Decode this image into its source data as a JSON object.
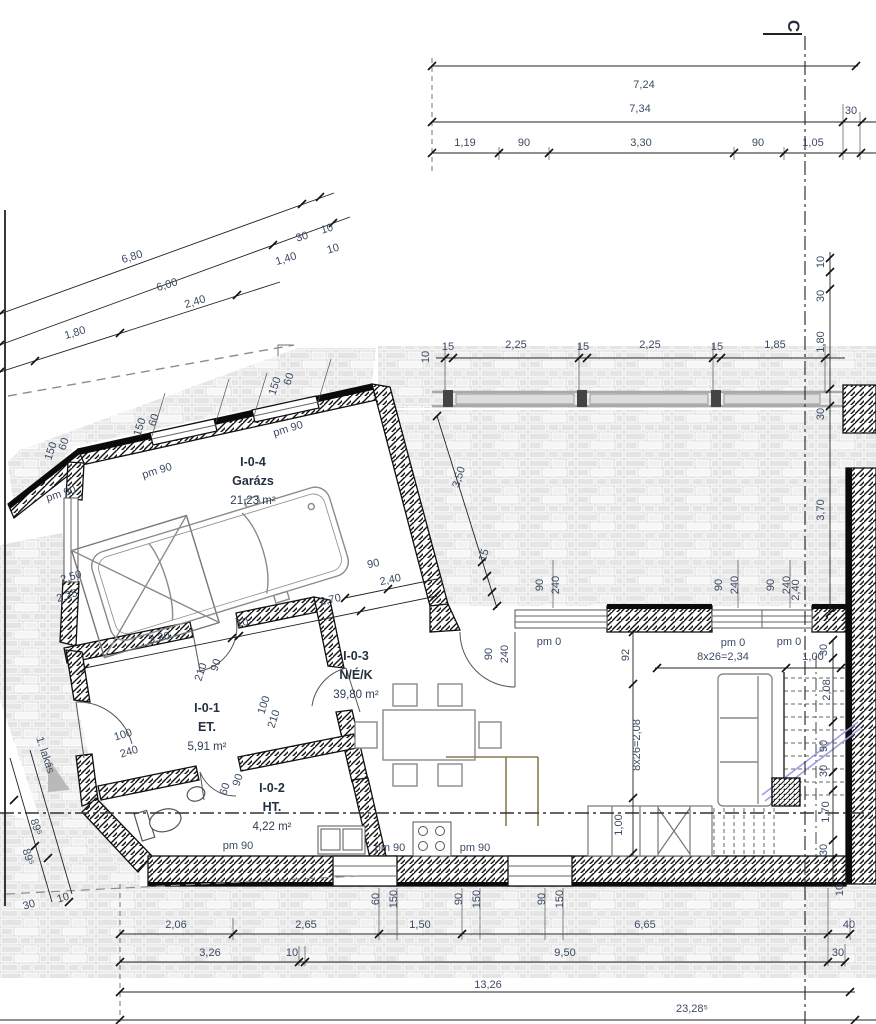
{
  "section_marker": "C",
  "apartment_pointer": "1. lakás",
  "rooms": [
    {
      "id": "I-0-4",
      "name": "Garázs",
      "area": "21,23 m²",
      "x": 253,
      "y": 466
    },
    {
      "id": "I-0-1",
      "name": "ET.",
      "area": "5,91 m²",
      "x": 207,
      "y": 712
    },
    {
      "id": "I-0-2",
      "name": "HT.",
      "area": "4,22 m²",
      "x": 272,
      "y": 792
    },
    {
      "id": "I-0-3",
      "name": "N/É/K",
      "area": "39,80 m²",
      "x": 356,
      "y": 660
    }
  ],
  "dimensions": [
    {
      "t": "7,24",
      "x": 644,
      "y": 88
    },
    {
      "t": "7,34",
      "x": 640,
      "y": 112
    },
    {
      "t": "30",
      "x": 851,
      "y": 114
    },
    {
      "t": "1,19",
      "x": 465,
      "y": 146
    },
    {
      "t": "90",
      "x": 524,
      "y": 146
    },
    {
      "t": "3,30",
      "x": 641,
      "y": 146
    },
    {
      "t": "90",
      "x": 758,
      "y": 146
    },
    {
      "t": "1,05",
      "x": 813,
      "y": 146
    },
    {
      "t": "6,80",
      "x": 133,
      "y": 260,
      "r": -17
    },
    {
      "t": "30",
      "x": 303,
      "y": 240,
      "r": -17
    },
    {
      "t": "10",
      "x": 328,
      "y": 232,
      "r": -17
    },
    {
      "t": "6,00",
      "x": 168,
      "y": 288,
      "r": -17
    },
    {
      "t": "1,40",
      "x": 287,
      "y": 262,
      "r": -17
    },
    {
      "t": "10",
      "x": 334,
      "y": 252,
      "r": -17
    },
    {
      "t": "1,80",
      "x": 76,
      "y": 336,
      "r": -17
    },
    {
      "t": "2,40",
      "x": 196,
      "y": 305,
      "r": -17
    },
    {
      "t": "15",
      "x": 448,
      "y": 350
    },
    {
      "t": "2,25",
      "x": 516,
      "y": 348
    },
    {
      "t": "15",
      "x": 583,
      "y": 350
    },
    {
      "t": "2,25",
      "x": 650,
      "y": 348
    },
    {
      "t": "15",
      "x": 717,
      "y": 350
    },
    {
      "t": "1,85",
      "x": 775,
      "y": 348
    },
    {
      "t": "10",
      "x": 429,
      "y": 357,
      "r": -90
    },
    {
      "t": "10",
      "x": 824,
      "y": 262,
      "r": -90
    },
    {
      "t": "30",
      "x": 824,
      "y": 296,
      "r": -90
    },
    {
      "t": "1,80",
      "x": 824,
      "y": 342,
      "r": -90
    },
    {
      "t": "30",
      "x": 824,
      "y": 414,
      "r": -90
    },
    {
      "t": "3,70",
      "x": 824,
      "y": 510,
      "r": -90
    },
    {
      "t": "2,40",
      "x": 799,
      "y": 590,
      "r": -90
    },
    {
      "t": "pm 90",
      "x": 62,
      "y": 497,
      "r": -17
    },
    {
      "t": "pm 90",
      "x": 158,
      "y": 474,
      "r": -17
    },
    {
      "t": "pm 90",
      "x": 289,
      "y": 432,
      "r": -17
    },
    {
      "t": "150",
      "x": 54,
      "y": 452,
      "r": -72
    },
    {
      "t": "60",
      "x": 67,
      "y": 445,
      "r": -72
    },
    {
      "t": "150",
      "x": 143,
      "y": 428,
      "r": -72
    },
    {
      "t": "60",
      "x": 157,
      "y": 421,
      "r": -72
    },
    {
      "t": "150",
      "x": 278,
      "y": 387,
      "r": -72
    },
    {
      "t": "60",
      "x": 292,
      "y": 380,
      "r": -72
    },
    {
      "t": "2,50",
      "x": 72,
      "y": 580,
      "r": -17
    },
    {
      "t": "2,25",
      "x": 68,
      "y": 599,
      "r": -17
    },
    {
      "t": "3,20",
      "x": 160,
      "y": 641,
      "r": -12
    },
    {
      "t": "10",
      "x": 243,
      "y": 626,
      "r": -12
    },
    {
      "t": "2,70",
      "x": 331,
      "y": 603,
      "r": -12
    },
    {
      "t": "90",
      "x": 374,
      "y": 567,
      "r": -12
    },
    {
      "t": "2,40",
      "x": 391,
      "y": 583,
      "r": -12
    },
    {
      "t": "100",
      "x": 124,
      "y": 738,
      "r": -17
    },
    {
      "t": "240",
      "x": 130,
      "y": 755,
      "r": -17
    },
    {
      "t": "210",
      "x": 204,
      "y": 673,
      "r": -72
    },
    {
      "t": "90",
      "x": 219,
      "y": 666,
      "r": -72
    },
    {
      "t": "100",
      "x": 267,
      "y": 706,
      "r": -72
    },
    {
      "t": "210",
      "x": 277,
      "y": 720,
      "r": -72
    },
    {
      "t": "90",
      "x": 241,
      "y": 781,
      "r": -72
    },
    {
      "t": "60",
      "x": 228,
      "y": 790,
      "r": -72
    },
    {
      "t": "pm 90",
      "x": 238,
      "y": 849
    },
    {
      "t": "pm 90",
      "x": 390,
      "y": 851
    },
    {
      "t": "pm 90",
      "x": 475,
      "y": 851
    },
    {
      "t": "3,50",
      "x": 462,
      "y": 478,
      "r": -73
    },
    {
      "t": "15",
      "x": 487,
      "y": 556,
      "r": -73
    },
    {
      "t": "90",
      "x": 543,
      "y": 585,
      "r": -90
    },
    {
      "t": "240",
      "x": 559,
      "y": 585,
      "r": -90
    },
    {
      "t": "90",
      "x": 492,
      "y": 654,
      "r": -90
    },
    {
      "t": "240",
      "x": 508,
      "y": 654,
      "r": -90
    },
    {
      "t": "pm 0",
      "x": 549,
      "y": 645
    },
    {
      "t": "90",
      "x": 722,
      "y": 585,
      "r": -90
    },
    {
      "t": "240",
      "x": 738,
      "y": 585,
      "r": -90
    },
    {
      "t": "90",
      "x": 774,
      "y": 585,
      "r": -90
    },
    {
      "t": "240",
      "x": 790,
      "y": 585,
      "r": -90
    },
    {
      "t": "pm 0",
      "x": 733,
      "y": 646
    },
    {
      "t": "pm 0",
      "x": 789,
      "y": 645
    },
    {
      "t": "92",
      "x": 629,
      "y": 655,
      "r": -90
    },
    {
      "t": "8x26=2,34",
      "x": 723,
      "y": 660
    },
    {
      "t": "1,00",
      "x": 813,
      "y": 660
    },
    {
      "t": "8x26=2,08",
      "x": 640,
      "y": 745,
      "r": -90
    },
    {
      "t": "1,00",
      "x": 622,
      "y": 825,
      "r": -90
    },
    {
      "t": "30",
      "x": 827,
      "y": 650,
      "r": -90
    },
    {
      "t": "2,08",
      "x": 830,
      "y": 690,
      "r": -90
    },
    {
      "t": "90",
      "x": 827,
      "y": 746,
      "r": -90
    },
    {
      "t": "30",
      "x": 827,
      "y": 771,
      "r": -90
    },
    {
      "t": "1,70",
      "x": 829,
      "y": 812,
      "r": -90
    },
    {
      "t": "30",
      "x": 827,
      "y": 850,
      "r": -90
    },
    {
      "t": "10",
      "x": 843,
      "y": 890,
      "r": -90
    },
    {
      "t": "1. lakás",
      "x": 42,
      "y": 756,
      "r": 72,
      "s": 12.5,
      "n": "apartment-label"
    },
    {
      "t": "89⁵",
      "x": 33,
      "y": 828,
      "r": 72
    },
    {
      "t": "89⁵",
      "x": 25,
      "y": 858,
      "r": 72
    },
    {
      "t": "30",
      "x": 30,
      "y": 908,
      "r": -17
    },
    {
      "t": "10",
      "x": 64,
      "y": 901,
      "r": -17
    },
    {
      "t": "2,06",
      "x": 176,
      "y": 928
    },
    {
      "t": "2,65",
      "x": 306,
      "y": 928
    },
    {
      "t": "1,50",
      "x": 420,
      "y": 928
    },
    {
      "t": "6,65",
      "x": 645,
      "y": 928
    },
    {
      "t": "40",
      "x": 849,
      "y": 928
    },
    {
      "t": "3,26",
      "x": 210,
      "y": 956
    },
    {
      "t": "10",
      "x": 292,
      "y": 956
    },
    {
      "t": "9,50",
      "x": 565,
      "y": 956
    },
    {
      "t": "30",
      "x": 838,
      "y": 956
    },
    {
      "t": "13,26",
      "x": 488,
      "y": 988
    },
    {
      "t": "23,28⁵",
      "x": 692,
      "y": 1012
    },
    {
      "t": "60",
      "x": 379,
      "y": 899,
      "r": -90
    },
    {
      "t": "150",
      "x": 397,
      "y": 899,
      "r": -90
    },
    {
      "t": "90",
      "x": 462,
      "y": 899,
      "r": -90
    },
    {
      "t": "150",
      "x": 480,
      "y": 899,
      "r": -90
    },
    {
      "t": "90",
      "x": 545,
      "y": 899,
      "r": -90
    },
    {
      "t": "150",
      "x": 563,
      "y": 899,
      "r": -90
    }
  ]
}
